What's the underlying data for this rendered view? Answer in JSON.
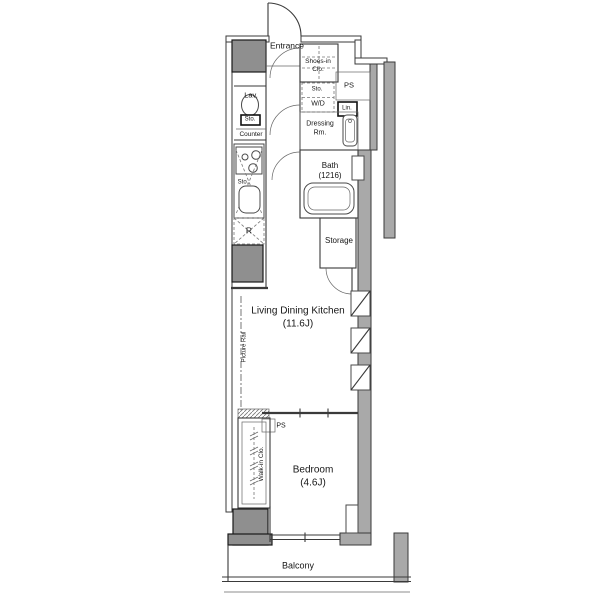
{
  "colors": {
    "bg": "#ffffff",
    "line": "#3a3a3a",
    "wall-fill": "#a9a9a9",
    "column-fill": "#8f8f8f",
    "fixture-fill": "#ffffff"
  },
  "plan": {
    "type": "apartment-floor-plan",
    "labels": {
      "entrance": "Entrance",
      "shoes_in_closet": "Shoes-in\nClo.",
      "ps_upper": "PS",
      "sto_wd": "Sto.",
      "washer_dryer": "W/D",
      "linen": "Lin.",
      "lavatory": "Lav.",
      "sto_toilet": "Sto.",
      "counter": "Counter",
      "dressing_room": "Dressing\nRm.",
      "bath": "Bath\n(1216)",
      "sto_kitchen": "Sto.",
      "refrigerator": "R",
      "storage": "Storage",
      "living_dining_kitchen": "Living Dining Kitchen\n(11.6J)",
      "picture_rail": "Picture Rail",
      "ps_lower": "PS",
      "walk_in_closet": "Walk-in Clo.",
      "bedroom": "Bedroom\n(4.6J)",
      "balcony": "Balcony"
    }
  }
}
